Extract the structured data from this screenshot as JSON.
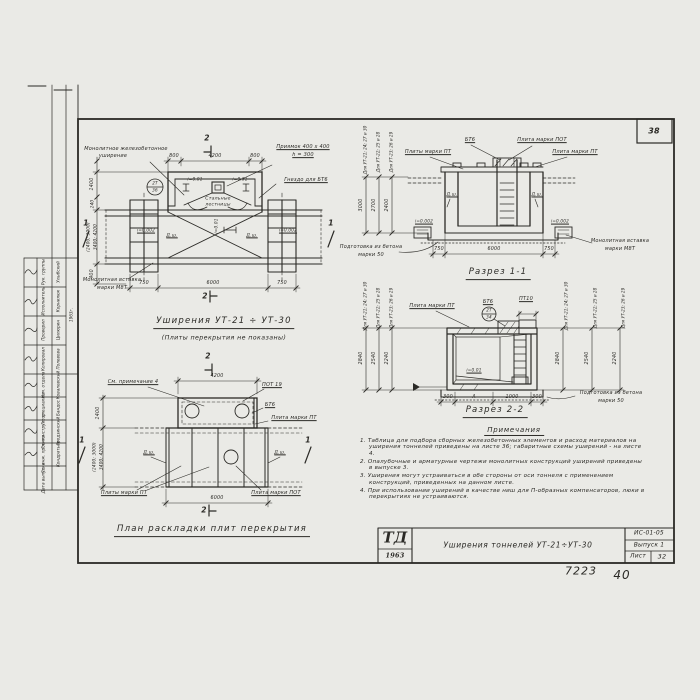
{
  "sheet": {
    "corner_number": "38",
    "handwritten_number": "7223",
    "handwritten_page": "40"
  },
  "titleblock": {
    "logo_abbr": "ТД",
    "logo_year": "1963",
    "drawing_title": "Уширения тоннелей УТ-21÷УТ-30",
    "series_code": "ИС-01-05",
    "issue": "Выпуск 1",
    "sheet_label": "Лист",
    "sheet_number": "32"
  },
  "stamp": {
    "date_year": "1963г.",
    "group1": {
      "rows": [
        {
          "role": "Рук. группы",
          "name": "Улыбский"
        },
        {
          "role": "Исполнитель",
          "name": "Корнилюк"
        },
        {
          "role": "Проверил",
          "name": "Цилюрин"
        },
        {
          "role": "Копировал",
          "name": "Полевова"
        }
      ]
    },
    "group2": {
      "rows": [
        {
          "role": "Нач. отдела",
          "name": "Ковалевский"
        },
        {
          "role": "Гл. специалист",
          "name": "Бандос"
        },
        {
          "role": "Гл. конструктор",
          "name": "Гродзинский"
        },
        {
          "role": "Гл. инж. проекта",
          "name": "Кондратьев"
        },
        {
          "role": "Дата выпуска",
          "name": ""
        }
      ]
    }
  },
  "plan_top": {
    "title": "Уширения УТ-21 ÷ УТ-30",
    "subtitle": "(Плиты перекрытия не показаны)",
    "labels": {
      "widening_1": "Монолитное железобетонное",
      "widening_2": "уширение",
      "pit_1": "Приямок 400 x 400",
      "pit_2": "h = 300",
      "socket": "Гнездо для БТ6",
      "ladders_1": "Стальные",
      "ladders_2": "лестницы",
      "insert_1": "Монолитная вставка",
      "insert_2": "марки М8Т",
      "joint": "Д.ш.",
      "slope_pit": "i=0.01",
      "slope_floor": "i=0.002"
    },
    "detail_mark": {
      "top": "2Т",
      "bottom": "36"
    },
    "dims": {
      "top": [
        "800",
        "4200",
        "800"
      ],
      "bottom": [
        "750",
        "6000",
        "750"
      ],
      "left": [
        "1400",
        "240",
        "(2400; 3000)",
        "3400; 4200",
        "400"
      ]
    },
    "marks": {
      "s1": "1",
      "s2": "2"
    }
  },
  "plan_bottom": {
    "title": "План раскладки плит перекрытия",
    "labels": {
      "see_note": "См. примечание 4",
      "pot19": "ПОТ 19",
      "bt6": "БТ6",
      "plate_pt": "Плита марки ПТ",
      "plates_pt": "Плиты марки ПТ",
      "plate_pot": "Плита марки ПОТ",
      "joint": "Д.ш."
    },
    "dims": {
      "top": "4200",
      "bottom": "6000",
      "left": [
        "1400",
        "(2400; 3000)",
        "3400; 4200"
      ]
    },
    "marks": {
      "s1": "1",
      "s2": "2"
    }
  },
  "section1": {
    "title": "Разрез 1-1",
    "labels": {
      "bt6": "БТ6",
      "plate_pot": "Плита марки ПОТ",
      "plates_pt": "Плиты марки ПТ",
      "plate_pt": "Плита марки ПТ",
      "joint": "Д.ш.",
      "slope": "i=0.002",
      "prep_1": "Подготовка из бетона",
      "prep_2": "марки 50",
      "insert_1": "Монолитная вставка",
      "insert_2": "марки М8Т"
    },
    "dims": {
      "bottom": [
        "750",
        "6000",
        "750"
      ]
    },
    "variants": [
      {
        "label": "Для УТ-21; 24; 27 и 30",
        "value": "3000"
      },
      {
        "label": "Для УТ-22; 25 и 28",
        "value": "2700"
      },
      {
        "label": "Для УТ-23; 26 и 29",
        "value": "2400"
      }
    ]
  },
  "section2": {
    "title": "Разрез 2-2",
    "labels": {
      "plate_pt": "Плита марки ПТ",
      "bt6": "БТ6",
      "pt10": "ПТ10",
      "slope": "i=0.01",
      "prep_1": "Подготовка из бетона",
      "prep_2": "марки 50"
    },
    "detail_mark": {
      "top": "2Т",
      "bottom": "34"
    },
    "dims": {
      "bottom": [
        "300",
        "А",
        "1000",
        "300"
      ]
    },
    "variants_left": [
      {
        "label": "Для УТ-21; 24; 27 и 30",
        "value": "2840"
      },
      {
        "label": "Для УТ-22; 25 и 28",
        "value": "2540"
      },
      {
        "label": "Для УТ-23; 26 и 29",
        "value": "2240"
      }
    ],
    "variants_right": [
      {
        "label": "Для УТ-21; 24; 27 и 30",
        "value": "2840"
      },
      {
        "label": "Для УТ-22; 25 и 28",
        "value": "2540"
      },
      {
        "label": "Для УТ-23; 26 и 29",
        "value": "2240"
      }
    ]
  },
  "notes": {
    "heading": "Примечания",
    "items": [
      "1. Таблица для подбора сборных железобетонных элементов и расход материалов на уширения тоннелей приведены на листе 36; габаритные схемы уширений - на листе 4.",
      "2. Опалубочные и арматурные чертежи монолитных конструкций уширений приведены в выпуске 3.",
      "3. Уширения могут устраиваться в обе стороны от оси тоннеля с применением конструкций, приведенных на данном листе.",
      "4. При использовании уширений в качестве ниш для П-образных компенсаторов, люки в перекрытиях не устраиваются."
    ]
  }
}
